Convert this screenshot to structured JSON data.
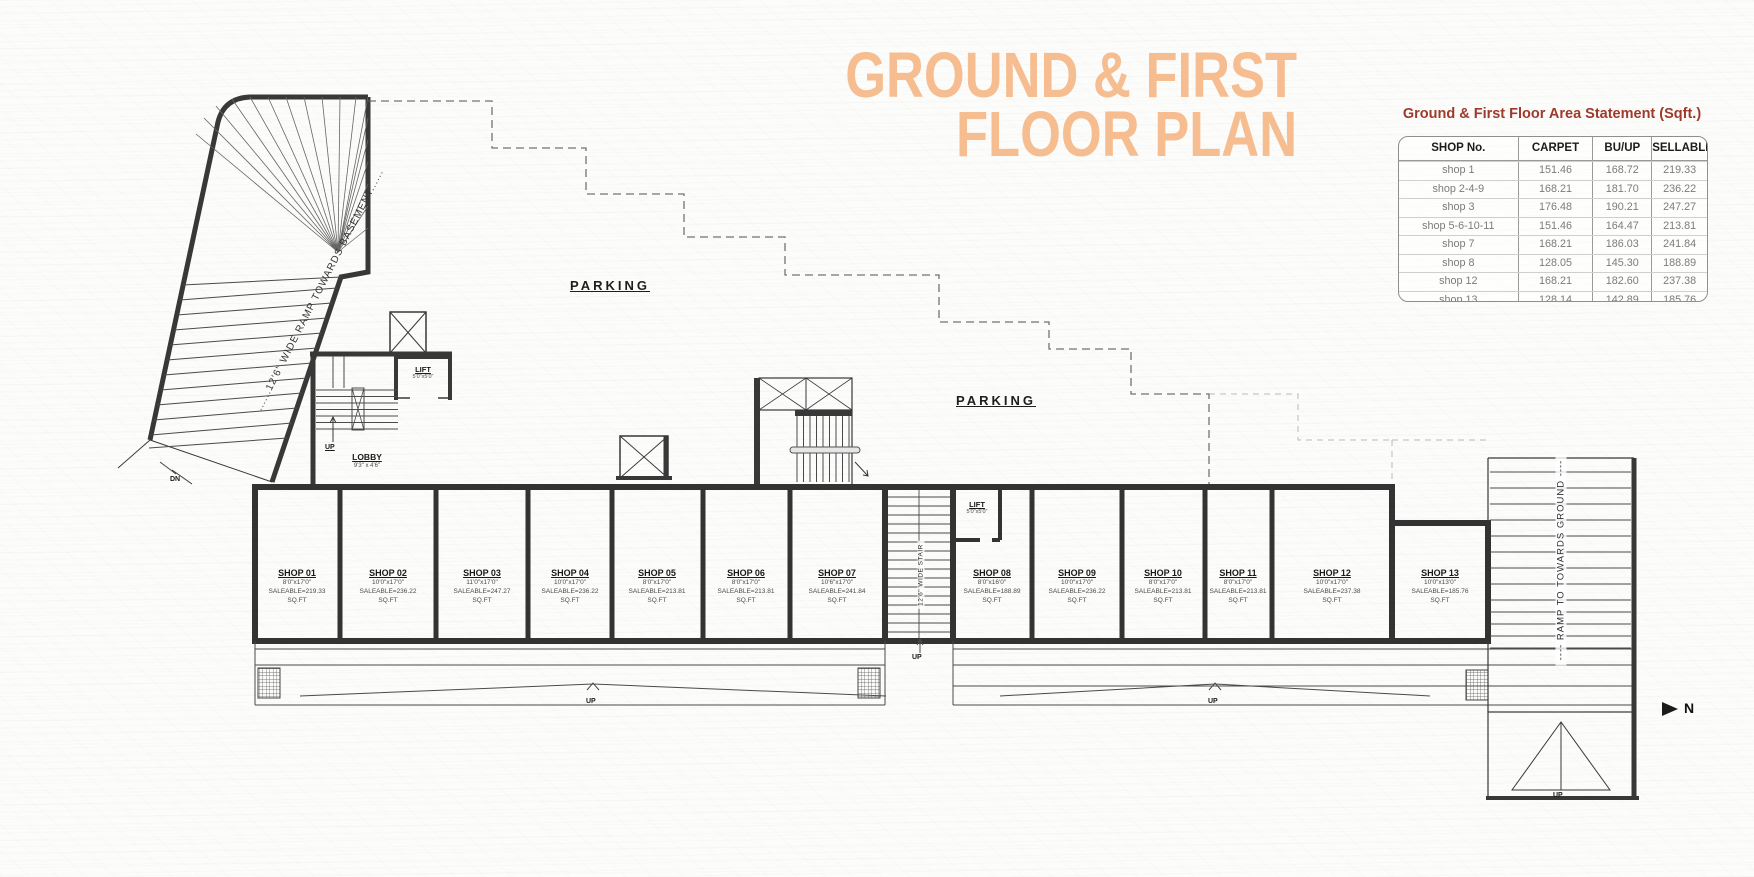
{
  "title": {
    "line1": "GROUND & FIRST",
    "line2": "FLOOR PLAN"
  },
  "area_table": {
    "title": "Ground & First Floor Area Statement (Sqft.)",
    "columns": [
      "SHOP No.",
      "CARPET",
      "BU/UP",
      "SELLABLE"
    ],
    "rows": [
      [
        "shop 1",
        "151.46",
        "168.72",
        "219.33"
      ],
      [
        "shop 2-4-9",
        "168.21",
        "181.70",
        "236.22"
      ],
      [
        "shop 3",
        "176.48",
        "190.21",
        "247.27"
      ],
      [
        "shop 5-6-10-11",
        "151.46",
        "164.47",
        "213.81"
      ],
      [
        "shop 7",
        "168.21",
        "186.03",
        "241.84"
      ],
      [
        "shop 8",
        "128.05",
        "145.30",
        "188.89"
      ],
      [
        "shop 12",
        "168.21",
        "182.60",
        "237.38"
      ],
      [
        "shop 13",
        "128.14",
        "142.89",
        "185.76"
      ]
    ]
  },
  "plan": {
    "parking_left": "PARKING",
    "parking_right": "PARKING",
    "basement_ramp_label": "......12'6\" WIDE RAMP TOWARDS BASEMENT......",
    "ground_ramp_label": "---- RAMP TO TOWARDS GROUND ----",
    "mid_stair_label": "12'6\" WIDE STAIR",
    "lobby": {
      "name": "LOBBY",
      "size": "9'3\" x 4'6\""
    },
    "lift_lobby": {
      "name": "LIFT",
      "size": "5'0\"x5'0\""
    },
    "lift_shops": {
      "name": "LIFT",
      "size": "5'0\"x5'0\""
    },
    "up_label": "UP",
    "dn_label": "DN",
    "north_label": "N",
    "shops": [
      {
        "name": "SHOP 01",
        "size": "8'0\"x17'0\"",
        "saleable": "SALEABLE=219.33",
        "unit": "SQ.FT"
      },
      {
        "name": "SHOP 02",
        "size": "10'0\"x17'0\"",
        "saleable": "SALEABLE=236.22",
        "unit": "SQ.FT"
      },
      {
        "name": "SHOP 03",
        "size": "11'0\"x17'0\"",
        "saleable": "SALEABLE=247.27",
        "unit": "SQ.FT"
      },
      {
        "name": "SHOP 04",
        "size": "10'0\"x17'0\"",
        "saleable": "SALEABLE=236.22",
        "unit": "SQ.FT"
      },
      {
        "name": "SHOP 05",
        "size": "8'0\"x17'0\"",
        "saleable": "SALEABLE=213.81",
        "unit": "SQ.FT"
      },
      {
        "name": "SHOP 06",
        "size": "8'0\"x17'0\"",
        "saleable": "SALEABLE=213.81",
        "unit": "SQ.FT"
      },
      {
        "name": "SHOP 07",
        "size": "10'6\"x17'0\"",
        "saleable": "SALEABLE=241.84",
        "unit": "SQ.FT"
      },
      {
        "name": "SHOP 08",
        "size": "8'0\"x16'0\"",
        "saleable": "SALEABLE=188.89",
        "unit": "SQ.FT"
      },
      {
        "name": "SHOP 09",
        "size": "10'0\"x17'0\"",
        "saleable": "SALEABLE=236.22",
        "unit": "SQ.FT"
      },
      {
        "name": "SHOP 10",
        "size": "8'0\"x17'0\"",
        "saleable": "SALEABLE=213.81",
        "unit": "SQ.FT"
      },
      {
        "name": "SHOP 11",
        "size": "8'0\"x17'0\"",
        "saleable": "SALEABLE=213.81",
        "unit": "SQ.FT"
      },
      {
        "name": "SHOP 12",
        "size": "10'0\"x17'0\"",
        "saleable": "SALEABLE=237.38",
        "unit": "SQ.FT"
      },
      {
        "name": "SHOP 13",
        "size": "10'0\"x13'0\"",
        "saleable": "SALEABLE=185.76",
        "unit": "SQ.FT"
      }
    ]
  },
  "colors": {
    "accent": "#f5bd90",
    "table_title": "#9e3a2b",
    "ink": "#3a3a3a"
  }
}
